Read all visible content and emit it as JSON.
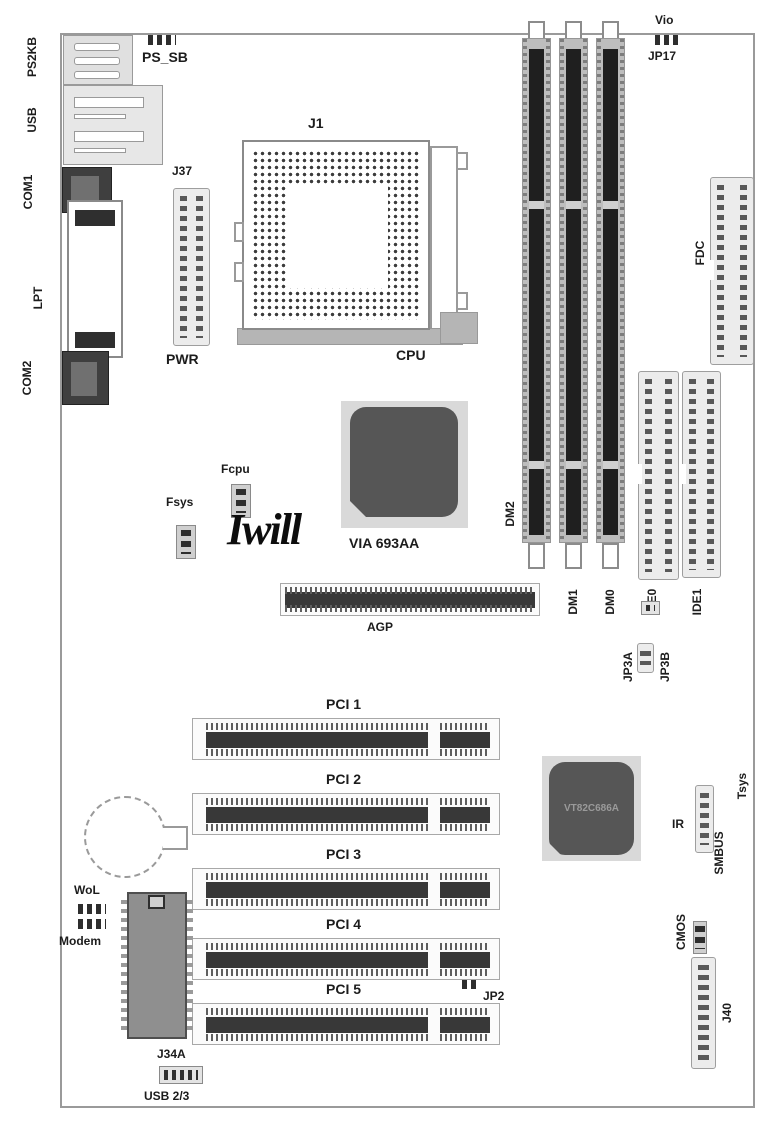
{
  "board": {
    "brand_logo": "Iwill",
    "chips": {
      "northbridge": "VIA 693AA",
      "southbridge": "VT82C686A"
    },
    "rear_io": {
      "ps2kb": "PS2KB",
      "usb": "USB",
      "com1": "COM1",
      "lpt": "LPT",
      "com2": "COM2"
    },
    "power": {
      "j37": "J37",
      "pwr": "PWR"
    },
    "cpu": {
      "j1": "J1",
      "cpu": "CPU"
    },
    "memory": {
      "dm2": "DM2",
      "dm1": "DM1",
      "dm0": "DM0"
    },
    "storage": {
      "fdc": "FDC",
      "ide0": "IDE0",
      "ide1": "IDE1"
    },
    "slots": {
      "agp": "AGP",
      "pci1": "PCI 1",
      "pci2": "PCI 2",
      "pci3": "PCI 3",
      "pci4": "PCI 4",
      "pci5": "PCI 5"
    },
    "fans": {
      "fcpu": "Fcpu",
      "fsys": "Fsys"
    },
    "headers": {
      "wol": "WoL",
      "modem": "Modem",
      "j34a": "J34A",
      "usb23": "USB 2/3",
      "ir": "IR",
      "smbus": "SMBUS",
      "tsys": "Tsys",
      "j40": "J40"
    },
    "jumpers": {
      "ps_sb": "PS_SB",
      "vio": "Vio",
      "jp17": "JP17",
      "jp3a": "JP3A",
      "jp3b": "JP3B",
      "jp2": "JP2",
      "cmos": "CMOS"
    }
  },
  "colors": {
    "board_outline": "#9a9a9a",
    "connector_fill": "#ececec",
    "slot_dark": "#1f1f1f",
    "chip_dark": "#565656",
    "label_text": "#1c1c1c"
  }
}
